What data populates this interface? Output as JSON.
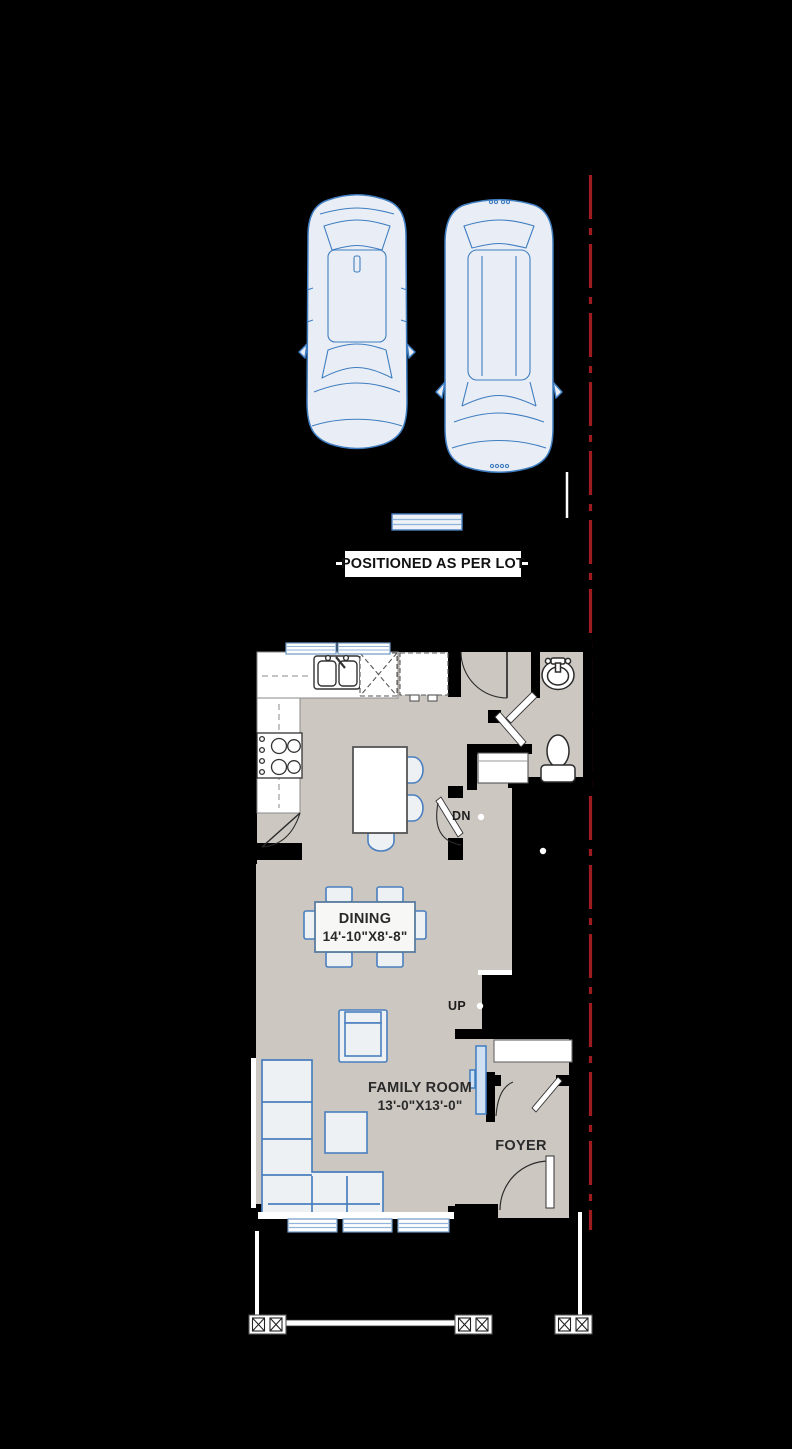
{
  "site_plan": {
    "positioned_label": "POSITIONED AS PER LOT",
    "cars": [
      "sedan-top-view",
      "suv-top-view"
    ],
    "property_line_color": "#9e1c20",
    "car_outline_color": "#3f7dc0",
    "parking_pad": "concrete-step-pad"
  },
  "floor_plan": {
    "floor_color": "#cdc7c2",
    "wall_color": "#000000",
    "furniture_outline_color": "#4a7fbe",
    "rooms": {
      "dining": {
        "name": "DINING",
        "dimensions": "14'-10\"X8'-8\""
      },
      "family_room": {
        "name": "FAMILY ROOM",
        "dimensions": "13'-0\"X13'-0\""
      },
      "foyer": {
        "name": "FOYER"
      }
    },
    "stairs": {
      "down": "DN",
      "up": "UP"
    },
    "fixtures": [
      "kitchen-sink",
      "dishwasher",
      "refrigerator",
      "range",
      "kitchen-counter",
      "kitchen-island",
      "bar-stool",
      "pantry-door",
      "dining-table",
      "dining-chair",
      "armchair",
      "sectional-sofa",
      "coffee-table",
      "tv",
      "entry-closet",
      "foyer-closet",
      "powder-room-sink",
      "toilet",
      "entry-door",
      "bath-door",
      "front-door",
      "window",
      "ceiling-light",
      "veranda-post",
      "veranda-railing",
      "veranda-column"
    ]
  }
}
